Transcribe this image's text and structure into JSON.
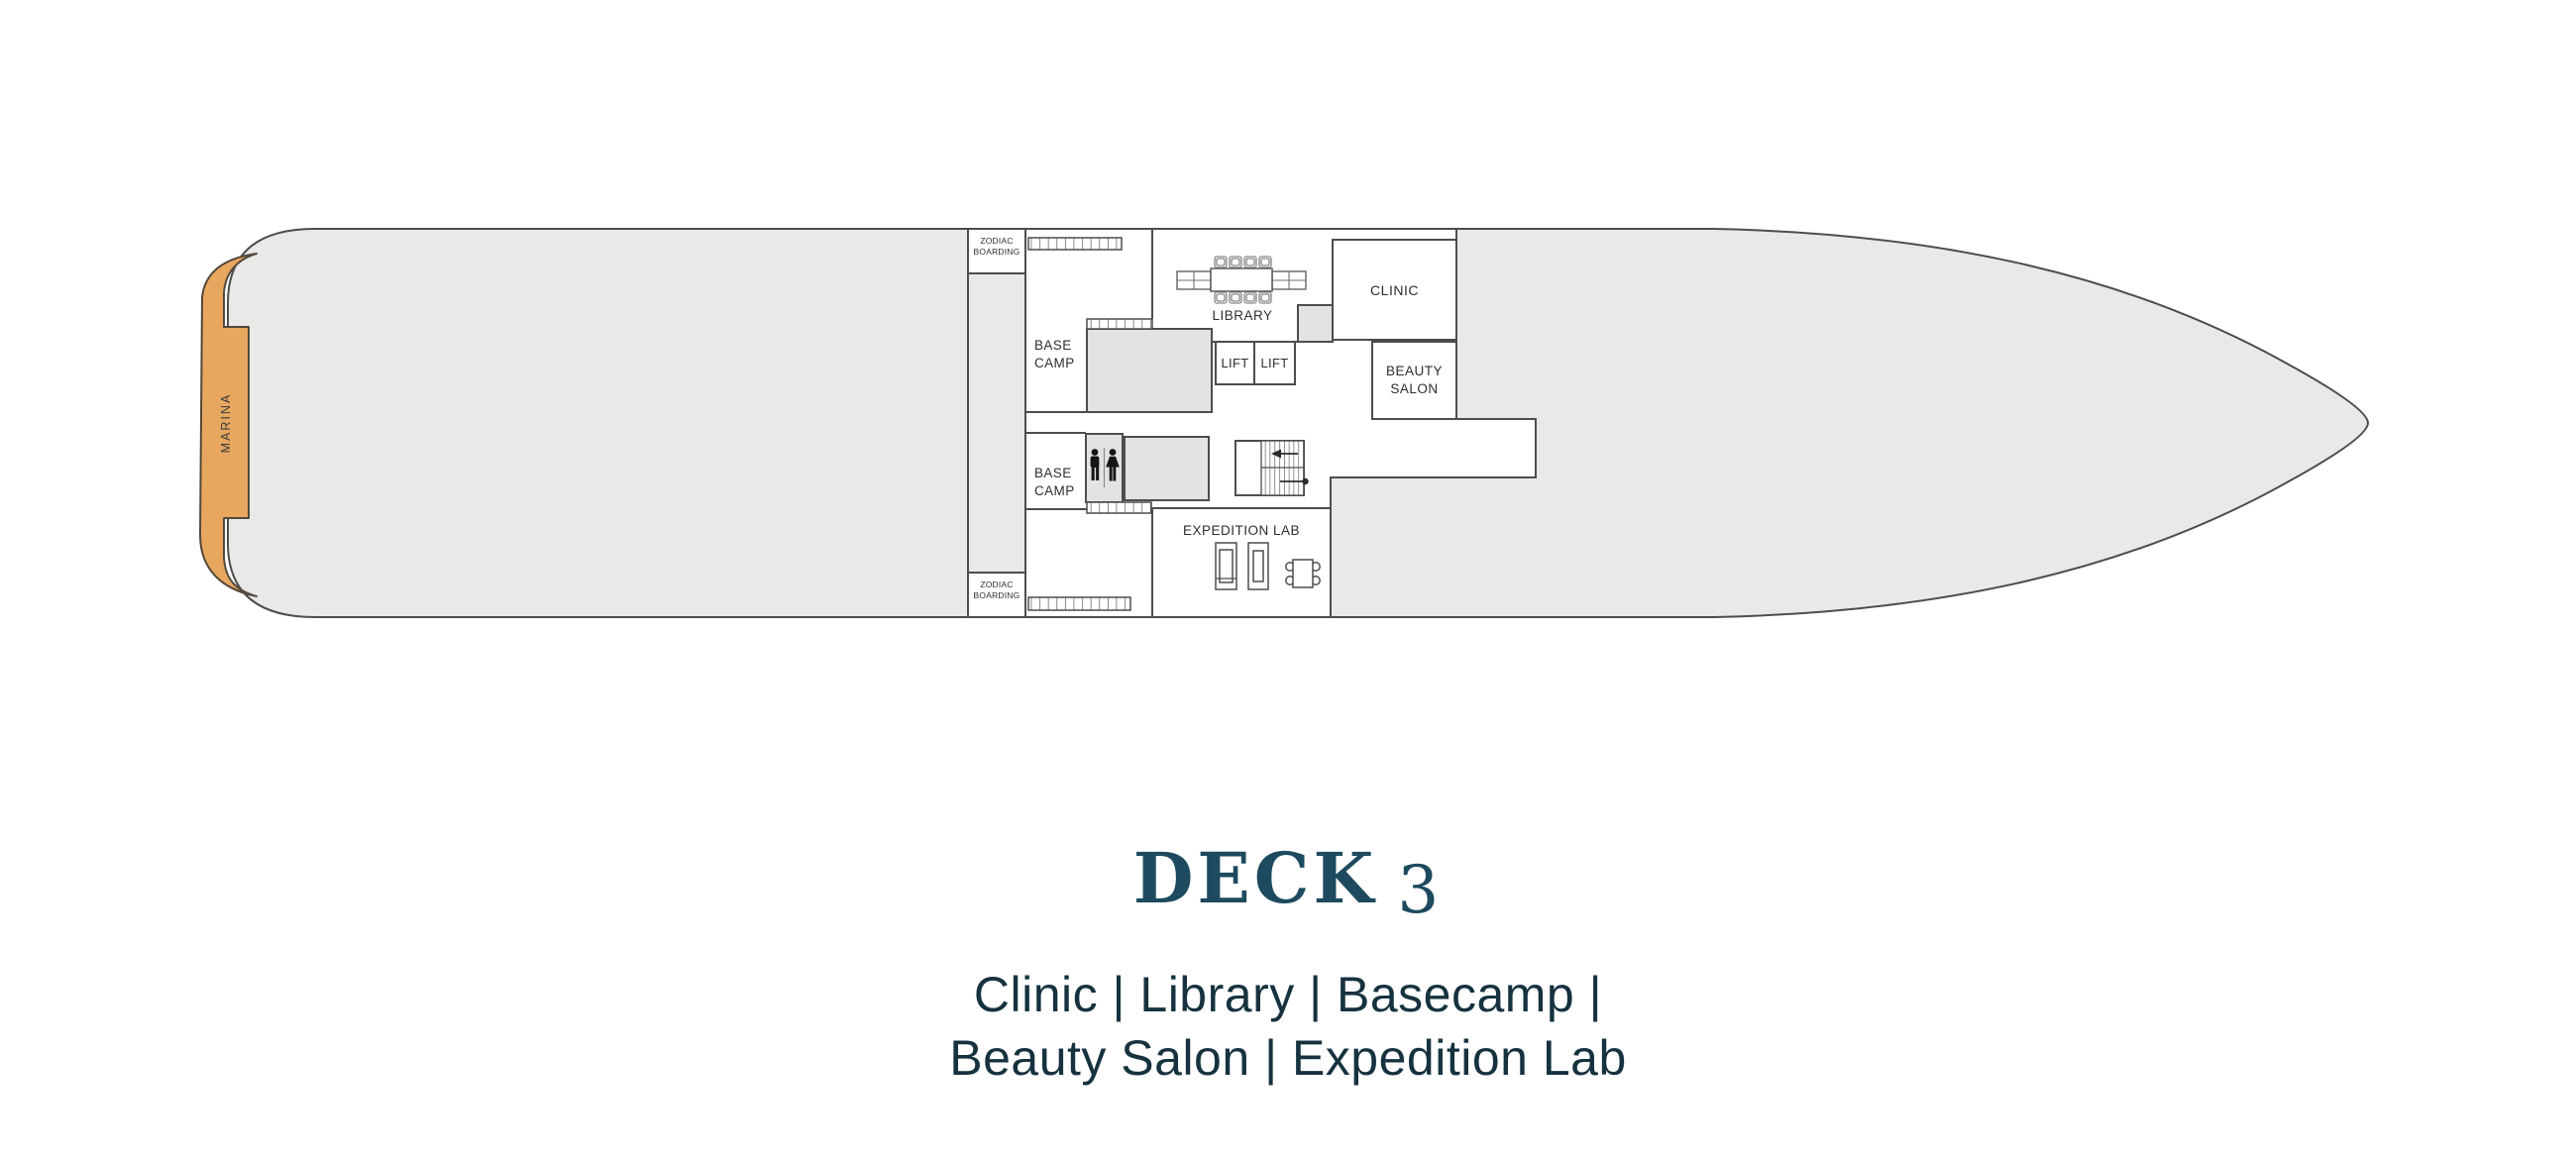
{
  "deck": {
    "title_main": "DECK",
    "title_number": "3",
    "subtitle_line1": "Clinic | Library | Basecamp |",
    "subtitle_line2": "Beauty Salon | Expedition Lab"
  },
  "rooms": {
    "marina": "MARINA",
    "zodiac_line1": "ZODIAC",
    "zodiac_line2": "BOARDING",
    "base_camp_line1": "BASE",
    "base_camp_line2": "CAMP",
    "library": "LIBRARY",
    "clinic": "CLINIC",
    "lift": "LIFT",
    "beauty_line1": "BEAUTY",
    "beauty_line2": "SALON",
    "expedition_lab": "EXPEDITION LAB"
  },
  "colors": {
    "hull_fill": "#e9e9e8",
    "outline": "#4d4d4d",
    "marina_fill": "#e8a75f",
    "block_fill": "#e3e3e2",
    "title_color": "#1d4a5e",
    "subtitle_color": "#16323f"
  }
}
